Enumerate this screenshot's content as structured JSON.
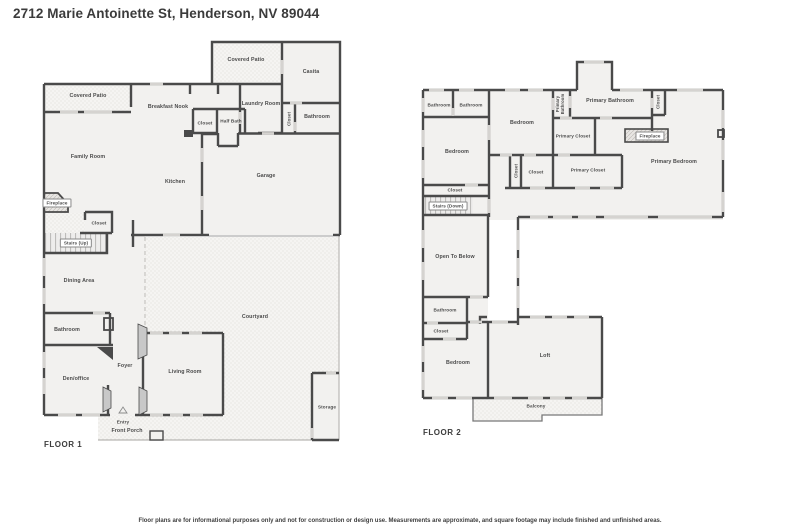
{
  "title": "2712 Marie Antoinette St, Henderson, NV 89044",
  "floors": {
    "floor1": {
      "name": "FLOOR 1",
      "rooms": {
        "covered_patio_left": "Covered Patio",
        "covered_patio_top": "Covered Patio",
        "casita": "Casita",
        "breakfast_nook": "Breakfast Nook",
        "laundry_room": "Laundry Room",
        "closet_kitchen": "Closet",
        "half_bath": "Half Bath",
        "closet_hall": "Closet",
        "bathroom_casita": "Bathroom",
        "family_room": "Family Room",
        "kitchen": "Kitchen",
        "garage": "Garage",
        "fireplace": "Fireplace",
        "closet_stairs": "Closet",
        "stairs_up": "Stairs (Up)",
        "dining_area": "Dining Area",
        "bathroom": "Bathroom",
        "den_office": "Den/office",
        "foyer": "Foyer",
        "living_room": "Living Room",
        "courtyard": "Courtyard",
        "entry": "Entry",
        "front_porch": "Front Porch",
        "storage": "Storage"
      }
    },
    "floor2": {
      "name": "FLOOR 2",
      "rooms": {
        "bathroom_a": "Bathroom",
        "bathroom_b": "Bathroom",
        "bedroom_left": "Bedroom",
        "closet_bedroom": "Closet",
        "stairs_down": "Stairs (Down)",
        "bedroom_mid": "Bedroom",
        "primary_bathroom_v": "Primary Bathroom",
        "primary_bathroom": "Primary Bathroom",
        "closet_pb": "Closet",
        "primary_closet_1": "Primary Closet",
        "fireplace": "Fireplace",
        "primary_bedroom": "Primary Bedroom",
        "closet_v": "Closet",
        "closet_mid": "Closet",
        "primary_closet_2": "Primary Closet",
        "open_to_below": "Open To Below",
        "bathroom_2": "Bathroom",
        "closet_2": "Closet",
        "bedroom_bottom": "Bedroom",
        "loft": "Loft",
        "balcony": "Balcony"
      }
    }
  },
  "footer": {
    "disclaimer": "Floor plans are for informational purposes only and not for construction or design use. Measurements are approximate, and square footage may include finished and unfinished areas."
  }
}
